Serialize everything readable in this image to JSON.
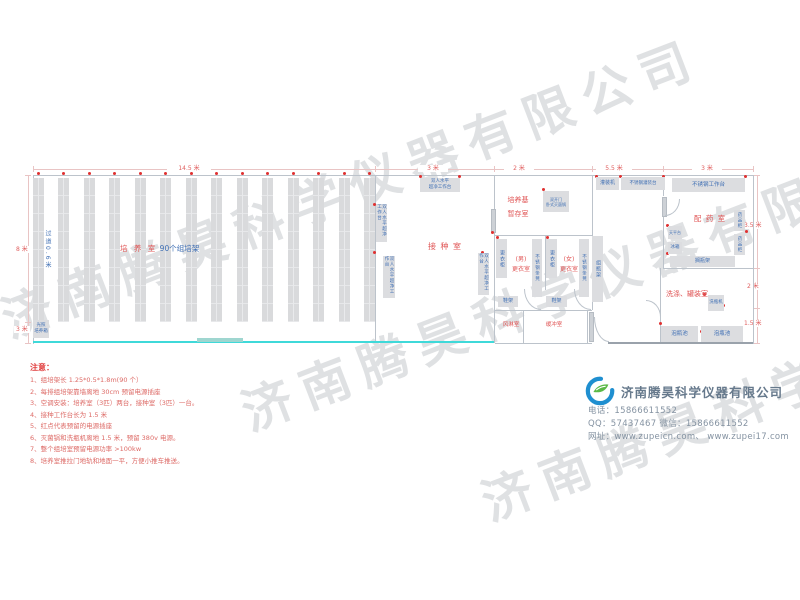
{
  "watermark": {
    "text": "济南腾昊科学仪器有限公司"
  },
  "plan": {
    "dims": {
      "top": [
        "14.5 米",
        "3 米",
        "2 米",
        "5.5 米",
        "3 米"
      ],
      "left": [
        "8 米",
        "3 米"
      ],
      "right": [
        "3.5 米",
        "2 米",
        "1.5 米"
      ]
    },
    "culture": {
      "room_label": "培 养 室",
      "racks_label": "90个组培架",
      "aisle_label": "过道0.6米",
      "incubator_label": "光照\n培养箱"
    },
    "inoculation": {
      "room_label": "接 种 室",
      "bench_label": "双人水平\n超净工作台",
      "bench_label_v": "双人水平超净工作台"
    },
    "medium_room": {
      "label": "培养基\n暂存室",
      "autoclave_label": "双开门\n卧式灭菌锅"
    },
    "changing": {
      "men_label": "(男)\n更衣室",
      "women_label": "(女)\n更衣室",
      "wardrobe_label": "更衣柜",
      "bench_label": "不锈钢条凳",
      "shoe_rack_label": "鞋架",
      "bottle_rack_label": "组瓶架",
      "air_shower_label": "风淋室",
      "buffer_label": "缓冲室"
    },
    "dispensing": {
      "room_label": "配 药 室",
      "filling_machine_label": "灌装机",
      "filling_table_label": "不锈钢灌装台",
      "work_table_label": "不锈钢工作台",
      "balance_label": "天平台",
      "fridge_label": "冰箱",
      "cabinet_label": "药品柜",
      "shelf_label": "搁瓶架"
    },
    "washing": {
      "room_label": "洗涤、罐装室",
      "washer_label": "洗瓶机",
      "pool_label": "泡瓶池"
    }
  },
  "notes": {
    "title": "注意：",
    "items": [
      "1、组培架长 1.25*0.5*1.8m(90 个）",
      "2、每排组培架靠墙离地 30cm 预留电源插座",
      "3、空调安装：培养室（3匹）两台，接种室（3匹）一台。",
      "4、接种工作台长为 1.5 米",
      "5、红点代表预留的电源插座",
      "6、灭菌锅和洗瓶机离地 1.5 米，预留 380v 电源。",
      "7、整个组培室预留电源功率 >100kw",
      "8、培养室推拉门地轨和地面一平，方便小推车推送。"
    ]
  },
  "company": {
    "name": "济南腾昊科学仪器有限公司",
    "phone": "电话：15866611552",
    "qq_wechat": "QQ：57437467   微信：15866611552",
    "website": "网址：www.zupeicn.com、 www.zupei17.com"
  }
}
